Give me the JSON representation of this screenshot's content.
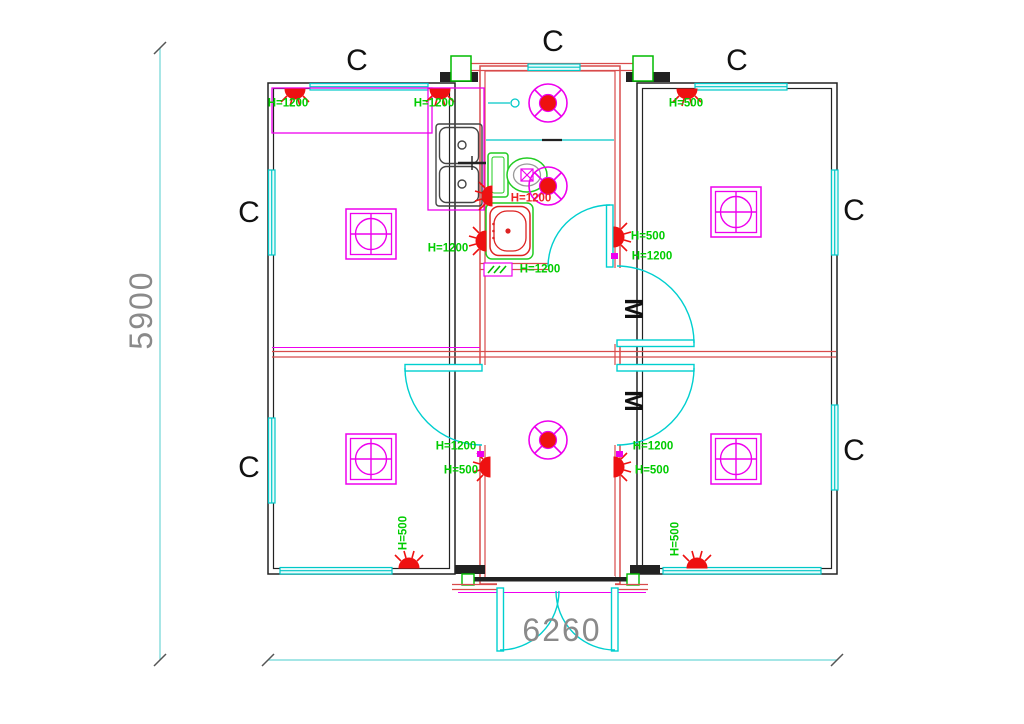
{
  "drawing": {
    "title": "container house floor plan - electrical and plumbing layout",
    "overall_width_label": "6260",
    "overall_height_label": "5900"
  },
  "colors": {
    "green": "#00cc00",
    "red": "#ee2222",
    "wall_red": "#d84b4b",
    "magenta": "#ee00ee",
    "cyan": "#00c8c8",
    "dim_line": "#6ed6d6",
    "wall_black": "#222222",
    "gray_text": "#8a8a8a"
  },
  "symbols": {
    "window_label": "C",
    "door_label": "M",
    "ceiling_lamp": "magenta double square with circle and cross (4x)",
    "exhaust_fan": "magenta circle with X spokes and red hub (3x)",
    "wall_lamp_socket": "red half-dome with rays (10x)",
    "kitchen_sink": "double-bowl sink with faucet",
    "toilet": "green tank and bowl with magenta crossed square",
    "wash_basin": "green/red rounded basin",
    "switch_panel": "magenta box with green hatch"
  },
  "annotations": {
    "items": [
      {
        "name": "window-label-top-left",
        "cls": "c",
        "text": "C",
        "x": 357,
        "y": 61
      },
      {
        "name": "window-label-top-center",
        "cls": "c",
        "text": "C",
        "x": 553,
        "y": 42
      },
      {
        "name": "window-label-top-right",
        "cls": "c",
        "text": "C",
        "x": 737,
        "y": 61
      },
      {
        "name": "window-label-left-upper",
        "cls": "c",
        "text": "C",
        "x": 249,
        "y": 213
      },
      {
        "name": "window-label-left-lower",
        "cls": "c",
        "text": "C",
        "x": 249,
        "y": 468
      },
      {
        "name": "window-label-right-upper",
        "cls": "c",
        "text": "C",
        "x": 854,
        "y": 211
      },
      {
        "name": "window-label-right-lower",
        "cls": "c",
        "text": "C",
        "x": 854,
        "y": 451
      },
      {
        "name": "door-label-upper",
        "cls": "m",
        "text": "M",
        "x": 634,
        "y": 309
      },
      {
        "name": "door-label-lower",
        "cls": "m",
        "text": "M",
        "x": 634,
        "y": 401
      },
      {
        "name": "height-label",
        "cls": "h-green",
        "text": "H=1200",
        "x": 288,
        "y": 104
      },
      {
        "name": "height-label",
        "cls": "h-green",
        "text": "H=1200",
        "x": 434,
        "y": 104
      },
      {
        "name": "height-label",
        "cls": "h-green",
        "text": "H=500",
        "x": 686,
        "y": 104
      },
      {
        "name": "height-label",
        "cls": "h-red",
        "text": "H=1200",
        "x": 531,
        "y": 199
      },
      {
        "name": "height-label",
        "cls": "h-green",
        "text": "H=1200",
        "x": 448,
        "y": 249
      },
      {
        "name": "height-label",
        "cls": "h-green",
        "text": "H=500",
        "x": 648,
        "y": 237
      },
      {
        "name": "height-label",
        "cls": "h-green",
        "text": "H=1200",
        "x": 652,
        "y": 257
      },
      {
        "name": "height-label",
        "cls": "h-green",
        "text": "H=1200",
        "x": 540,
        "y": 270
      },
      {
        "name": "height-label",
        "cls": "h-green",
        "text": "H=1200",
        "x": 456,
        "y": 447
      },
      {
        "name": "height-label",
        "cls": "h-green",
        "text": "H=500",
        "x": 461,
        "y": 471
      },
      {
        "name": "height-label",
        "cls": "h-green",
        "text": "H=1200",
        "x": 653,
        "y": 447
      },
      {
        "name": "height-label",
        "cls": "h-green",
        "text": "H=500",
        "x": 652,
        "y": 471
      },
      {
        "name": "height-label",
        "cls": "h-green vrot",
        "text": "H=500",
        "x": 404,
        "y": 533
      },
      {
        "name": "height-label",
        "cls": "h-green vrot",
        "text": "H=500",
        "x": 676,
        "y": 539
      },
      {
        "name": "dim-height",
        "cls": "dim vrot",
        "text": "5900",
        "x": 141,
        "y": 310
      },
      {
        "name": "dim-width",
        "cls": "dim",
        "text": "6260",
        "x": 562,
        "y": 630
      }
    ]
  }
}
